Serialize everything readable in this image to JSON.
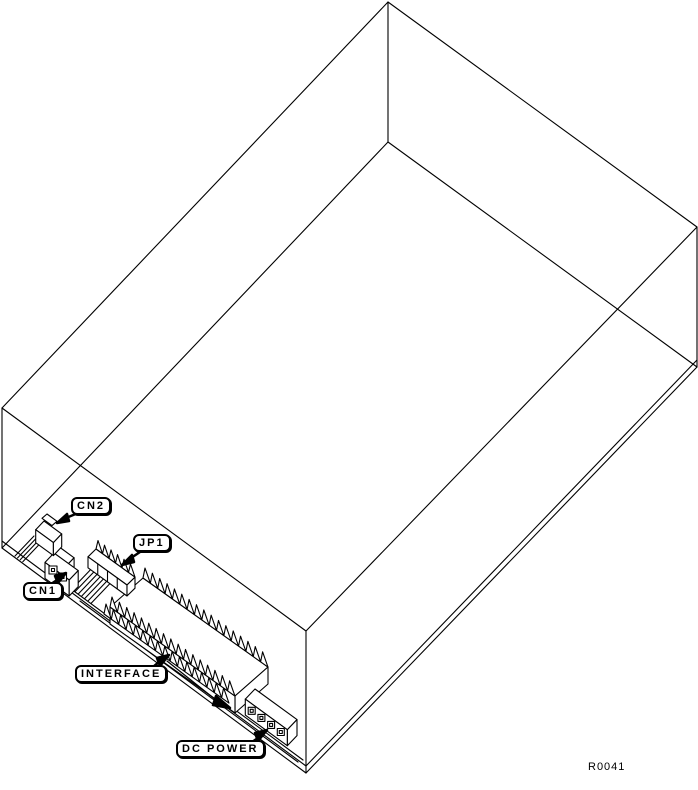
{
  "diagram": {
    "reference_code": "R0041",
    "callouts": [
      {
        "id": "cn2",
        "label": "CN2"
      },
      {
        "id": "jp1",
        "label": "JP1"
      },
      {
        "id": "cn1",
        "label": "CN1"
      },
      {
        "id": "interface",
        "label": "INTERFACE"
      },
      {
        "id": "dc_power",
        "label": "DC POWER"
      }
    ]
  },
  "colors": {
    "line": "#000000",
    "background": "#ffffff"
  }
}
